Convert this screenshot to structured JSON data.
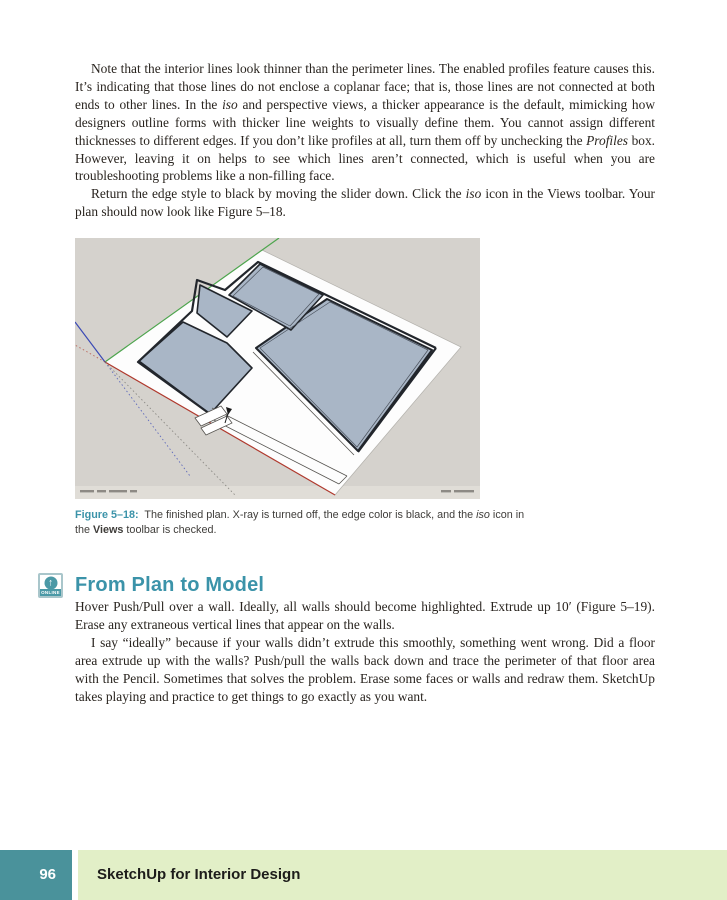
{
  "content": {
    "paragraphs": [
      {
        "html": "Note that the interior lines look thinner than the perimeter lines. The enabled profiles feature causes this. It&#8217;s indicating that those lines do not enclose a coplanar face; that is, those lines are not connected at both ends to other lines. In the <i>iso</i> and perspective views, a thicker appearance is the default, mimicking how designers outline forms with thicker line weights to visually define them. You cannot assign different thicknesses to different edges. If you don&#8217;t like profiles at all, turn them off by unchecking the <i>Profiles</i> box. However, leaving it on helps to see which lines aren&#8217;t connected, which is useful when you are troubleshooting problems like a non-filling face."
      },
      {
        "html": "Return the edge style to black by moving the slider down. Click the <i>iso</i> icon in the Views toolbar. Your plan should now look like Figure 5&#8211;18."
      }
    ]
  },
  "figure": {
    "caption_label": "Figure 5&#8211;18:",
    "caption_html": "&nbsp; The finished plan. X-ray is turned off, the edge color is black, and the <i>iso</i> icon in the <b>Views</b> toolbar is checked.",
    "colors": {
      "background": "#d5d2cd",
      "status_strip": "#e0ddd7",
      "sheet": "#fdfdfd",
      "floor_fill": "#a9b6c6",
      "edge_dark": "#22262c",
      "axis_green": "#4da54d",
      "axis_red": "#b03a2e",
      "axis_blue": "#3a49b5"
    }
  },
  "section": {
    "icon_arrow": "&#8593;",
    "icon_label": "ONLINE",
    "title": "From Plan to Model",
    "paragraphs": [
      {
        "html": "Hover Push/Pull over a wall. Ideally, all walls should become highlighted. Extrude up 10&#8242; (Figure 5&#8211;19). Erase any extraneous vertical lines that appear on the walls."
      },
      {
        "html": "I say &#8220;ideally&#8221; because if your walls didn&#8217;t extrude this smoothly, something went wrong. Did a floor area extrude up with the walls? Push/pull the walls back down and trace the perimeter of that floor area with the Pencil. Sometimes that solves the problem. Erase some faces or walls and redraw them. SketchUp takes playing and practice to get things to go exactly as you want."
      }
    ]
  },
  "footer": {
    "page_number": "96",
    "book_title": "SketchUp for Interior Design",
    "colors": {
      "page_tab": "#4a929b",
      "band": "#e2efc7"
    }
  },
  "accent_colors": {
    "heading_teal": "#3b93a9",
    "caption_teal": "#3b93a9"
  }
}
